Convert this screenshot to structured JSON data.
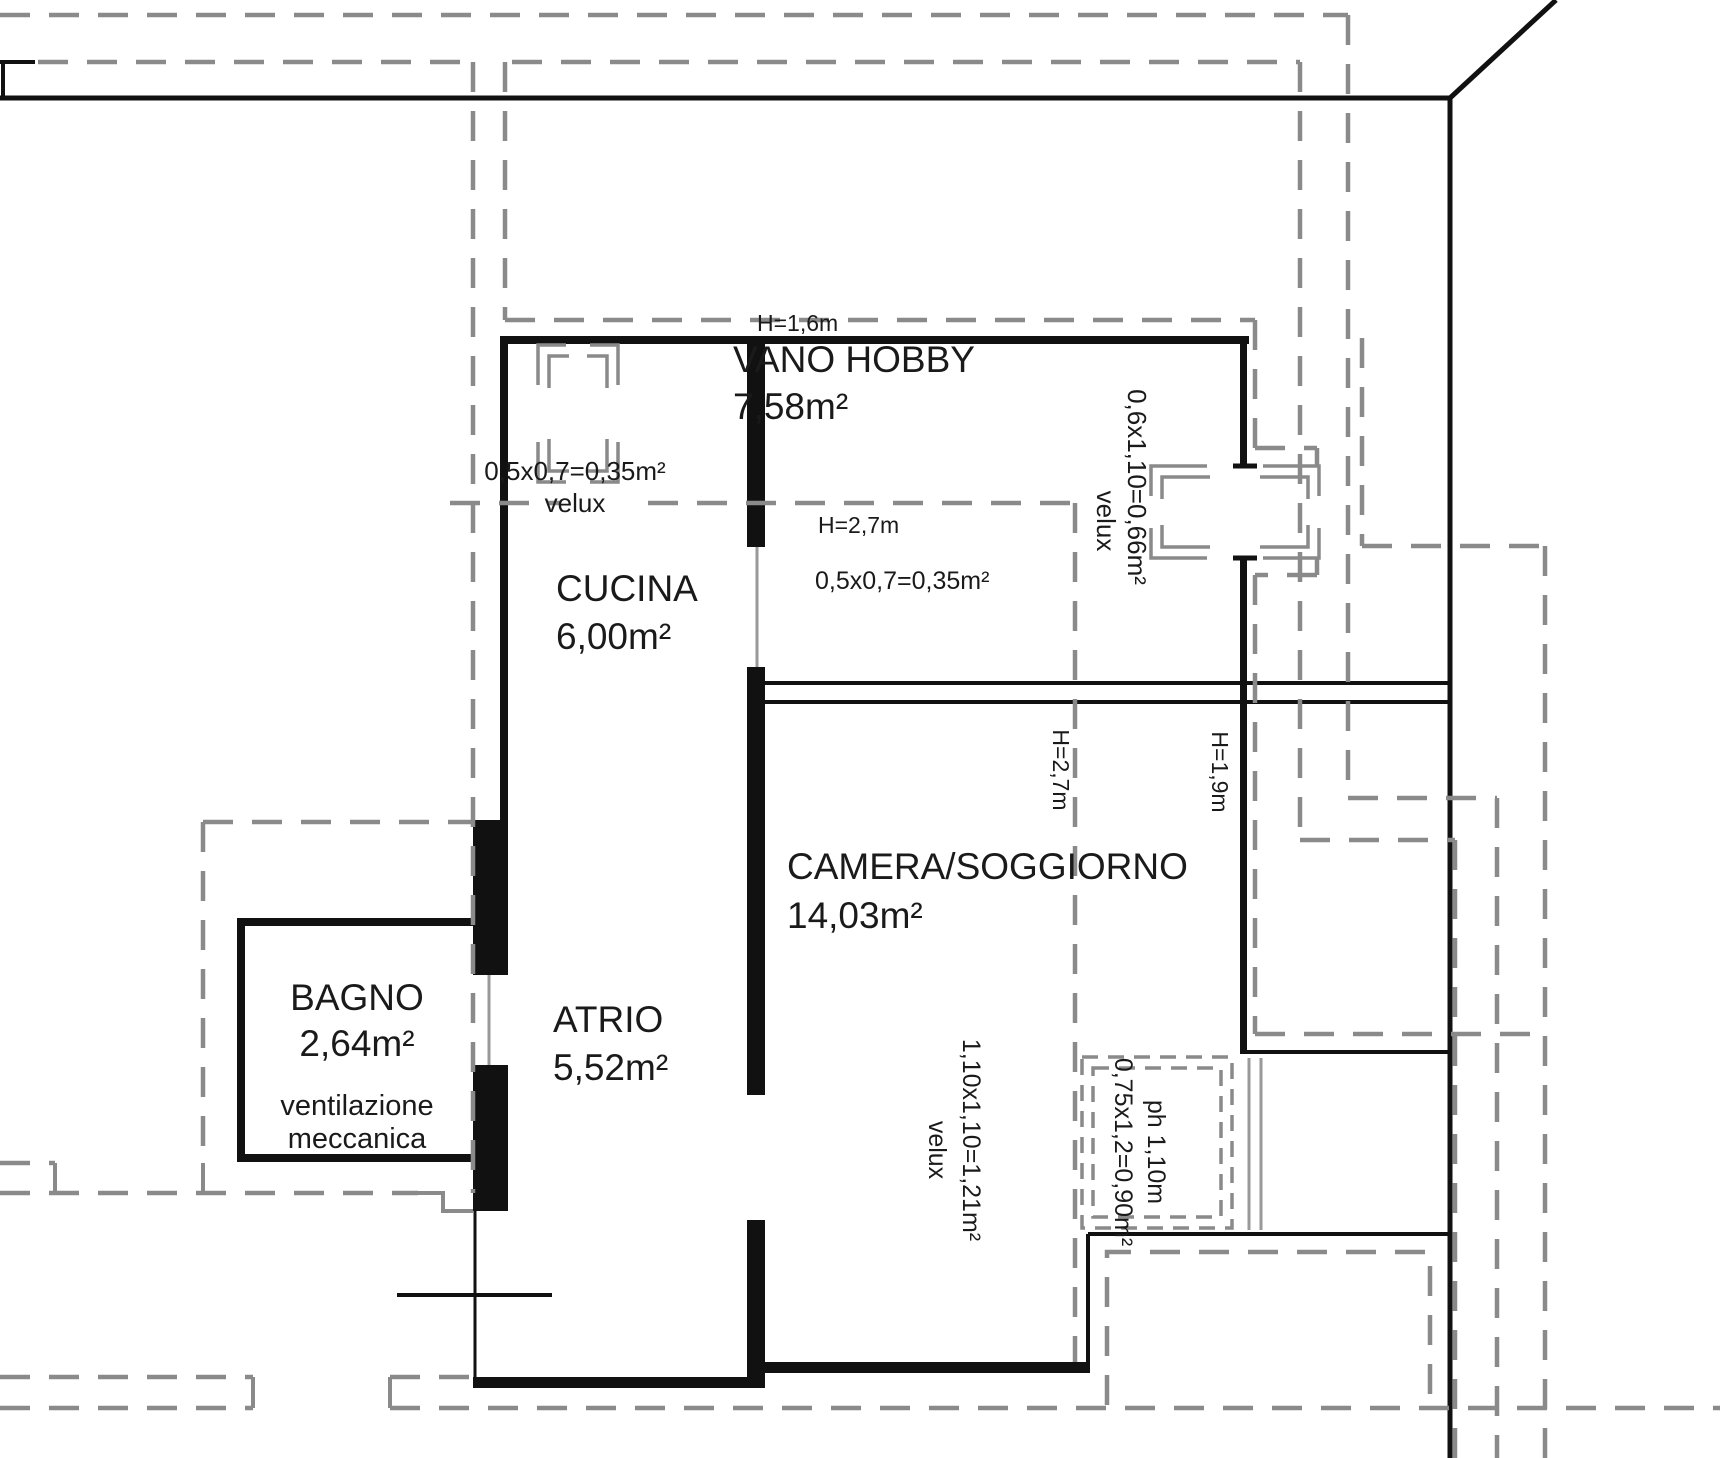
{
  "plan": {
    "title": "attic floor plan",
    "rooms": {
      "vano_hobby": {
        "name": "VANO HOBBY",
        "area": "7,58m²",
        "height_low": "H=1,6m",
        "height_main": "H=2,7m",
        "skylight_dim": "0,5x0,7=0,35m²"
      },
      "cucina": {
        "name": "CUCINA",
        "area": "6,00m²"
      },
      "camera_soggiorno": {
        "name": "CAMERA/SOGGIORNO",
        "area": "14,03m²",
        "height_main": "H=2,7m",
        "height_low": "H=1,9m"
      },
      "bagno": {
        "name": "BAGNO",
        "area": "2,64m²",
        "note_line1": "ventilazione",
        "note_line2": "meccanica"
      },
      "atrio": {
        "name": "ATRIO",
        "area": "5,52m²"
      }
    },
    "skylights": {
      "cucina_roof": {
        "dim": "0,5x0,7=0,35m²",
        "label": "velux"
      },
      "east_roof": {
        "dim": "0,6x1,10=0,66m²",
        "label": "velux"
      },
      "south_roof": {
        "dim": "1,10x1,10=1,21m²",
        "label": "velux"
      },
      "east_window": {
        "dim": "0,75x1,2=0,90m²",
        "label": "ph 1,10m"
      }
    }
  }
}
